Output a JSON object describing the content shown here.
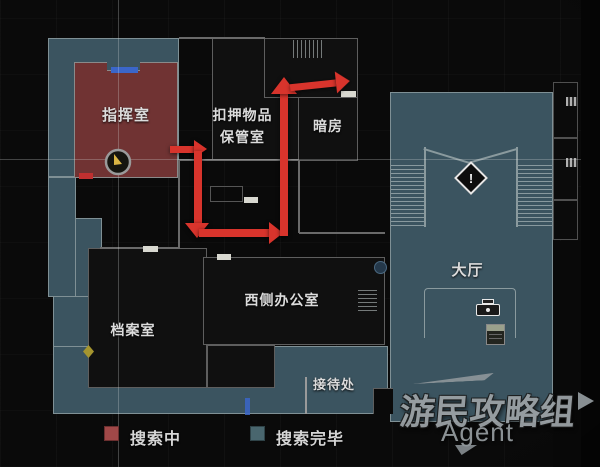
{
  "map": {
    "rooms": {
      "command": "指挥室",
      "evidence_line1": "扣押物品",
      "evidence_line2": "保管室",
      "darkroom": "暗房",
      "hall": "大厅",
      "west_office": "西侧办公室",
      "records": "档案室",
      "reception": "接待处"
    },
    "alert_mark": "!"
  },
  "legend": {
    "searching": "搜索中",
    "searching_color": "#a04848",
    "complete": "搜索完毕",
    "complete_color": "#49666e"
  },
  "watermark": {
    "title": "游民攻略组",
    "subtitle": "Agent"
  },
  "colors": {
    "route_red": "#d8342c",
    "room_searching": "#703333",
    "room_complete": "#3b5460",
    "door_blue": "#3b66c9"
  }
}
